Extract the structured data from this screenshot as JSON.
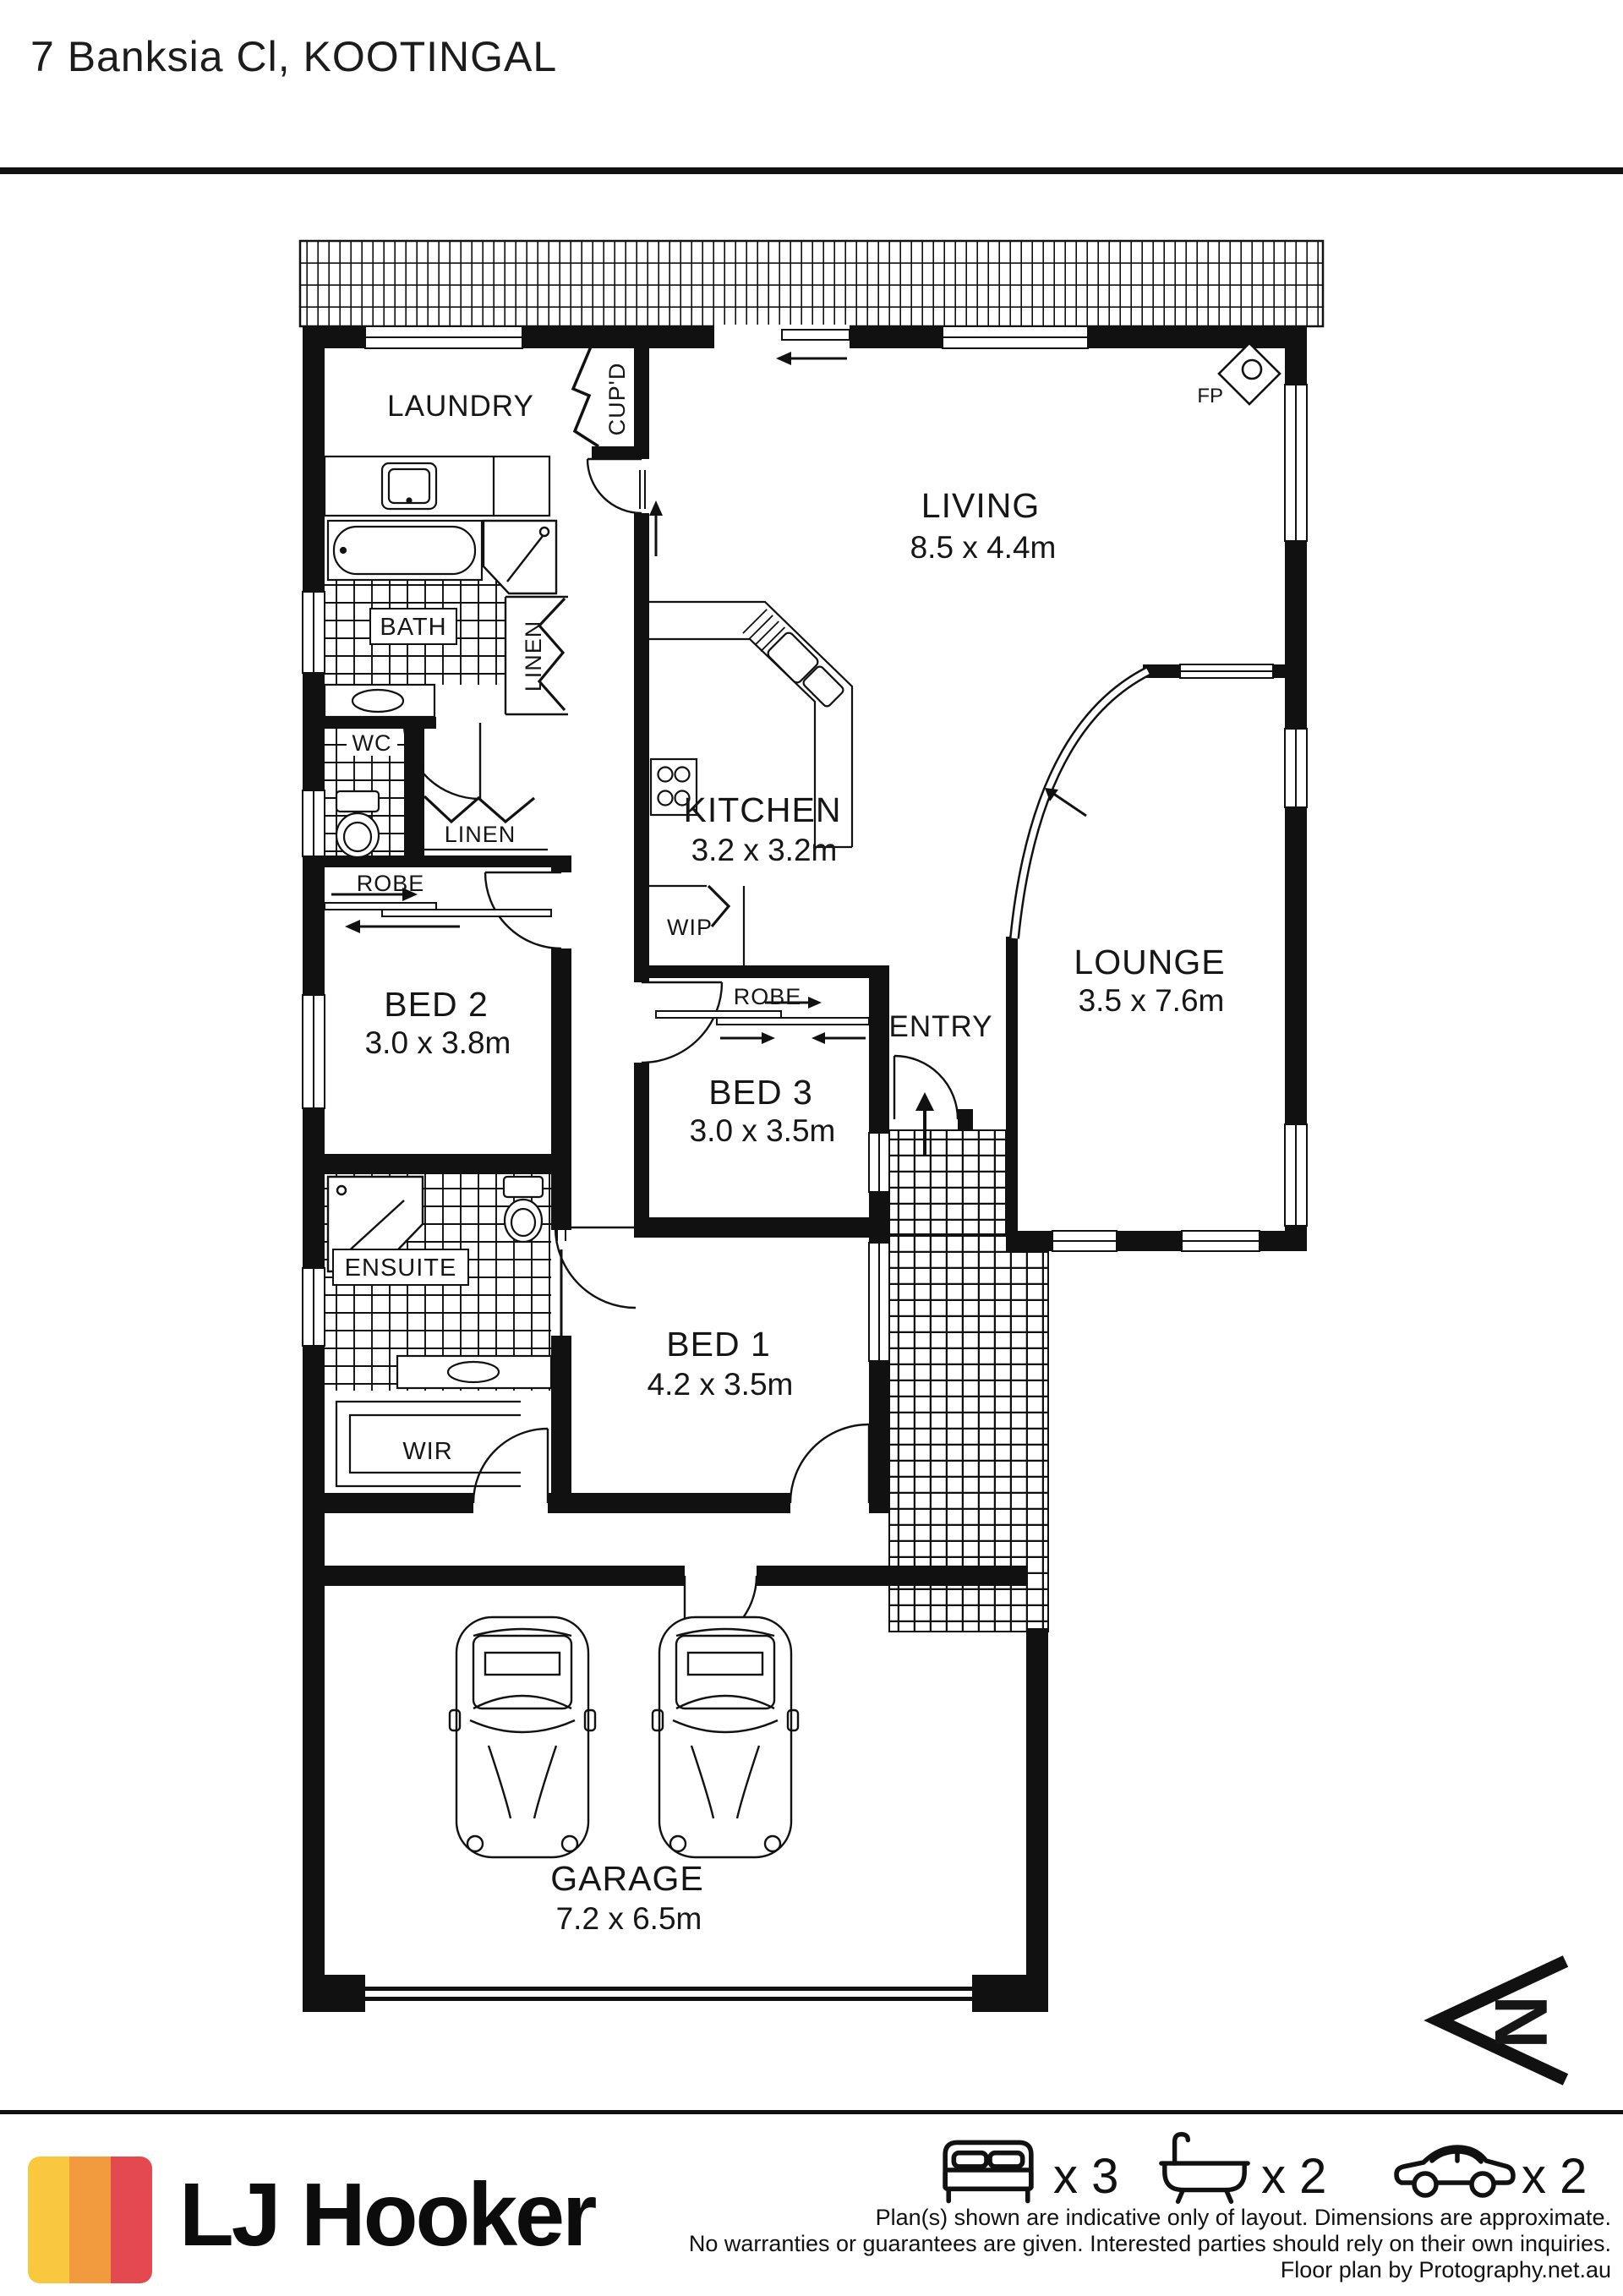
{
  "title": "7 Banksia Cl, KOOTINGAL",
  "rooms": {
    "laundry": {
      "name": "LAUNDRY"
    },
    "cupd": {
      "name": "CUP'D"
    },
    "living": {
      "name": "LIVING",
      "dims": "8.5 x 4.4m"
    },
    "fireplace": {
      "name": "FP"
    },
    "bath": {
      "name": "BATH"
    },
    "linen_bath": {
      "name": "LINEN"
    },
    "wc": {
      "name": "WC"
    },
    "linen_hall": {
      "name": "LINEN"
    },
    "robe_bed2": {
      "name": "ROBE"
    },
    "bed2": {
      "name": "BED 2",
      "dims": "3.0 x 3.8m"
    },
    "kitchen": {
      "name": "KITCHEN",
      "dims": "3.2 x 3.2m"
    },
    "wip": {
      "name": "WIP"
    },
    "robe_bed3": {
      "name": "ROBE"
    },
    "bed3": {
      "name": "BED 3",
      "dims": "3.0 x 3.5m"
    },
    "entry": {
      "name": "ENTRY"
    },
    "lounge": {
      "name": "LOUNGE",
      "dims": "3.5 x 7.6m"
    },
    "ensuite": {
      "name": "ENSUITE"
    },
    "bed1": {
      "name": "BED 1",
      "dims": "4.2 x 3.5m"
    },
    "wir": {
      "name": "WIR"
    },
    "garage": {
      "name": "GARAGE",
      "dims": "7.2 x 6.5m"
    }
  },
  "compass": {
    "label": "N"
  },
  "footer": {
    "brand": "LJ Hooker",
    "beds_label": "x 3",
    "baths_label": "x 2",
    "cars_label": "x 2",
    "disclaimer_line1": "Plan(s) shown are indicative only of layout. Dimensions are approximate.",
    "disclaimer_line2": "No warranties or guarantees are given. Interested parties should rely on their own inquiries.",
    "disclaimer_line3": "Floor plan by Protography.net.au"
  },
  "colors": {
    "ink": "#111111",
    "brand_yellow": "#FAC83F",
    "brand_orange": "#F19A3E",
    "brand_red": "#E3494E"
  }
}
